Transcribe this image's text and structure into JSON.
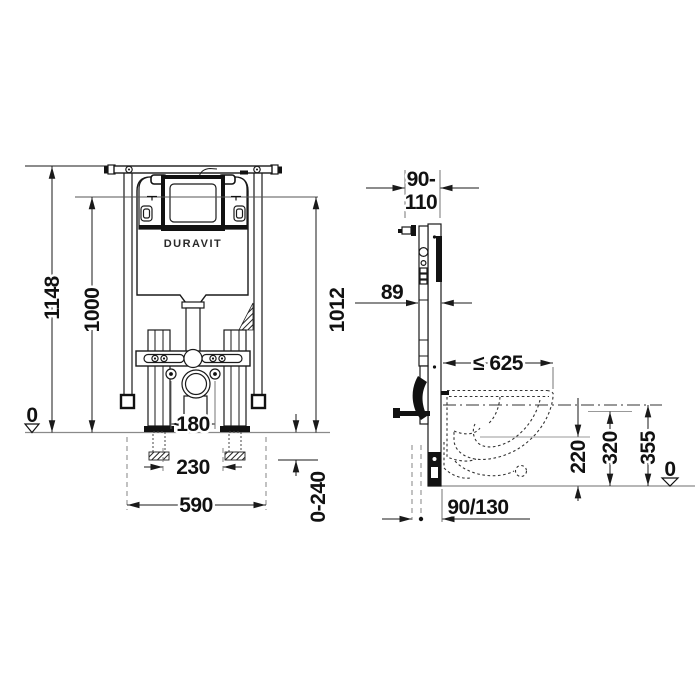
{
  "brand": "DURAVIT",
  "front_view": {
    "total_height": "1148",
    "cistern_height": "1000",
    "panel_height": "1012",
    "datum": "0",
    "stud_spacing": "180",
    "anchor_spacing": "230",
    "frame_width": "590",
    "foot_adjustment": "0-240"
  },
  "side_view": {
    "depth_range_top": "90-",
    "depth_range_bottom": "110",
    "frame_depth": "89",
    "bowl_projection": "≤ 625",
    "outlet_height": "220",
    "rim_reference": "320",
    "bracket_height": "355",
    "datum": "0",
    "drain_offset": "90/130"
  }
}
